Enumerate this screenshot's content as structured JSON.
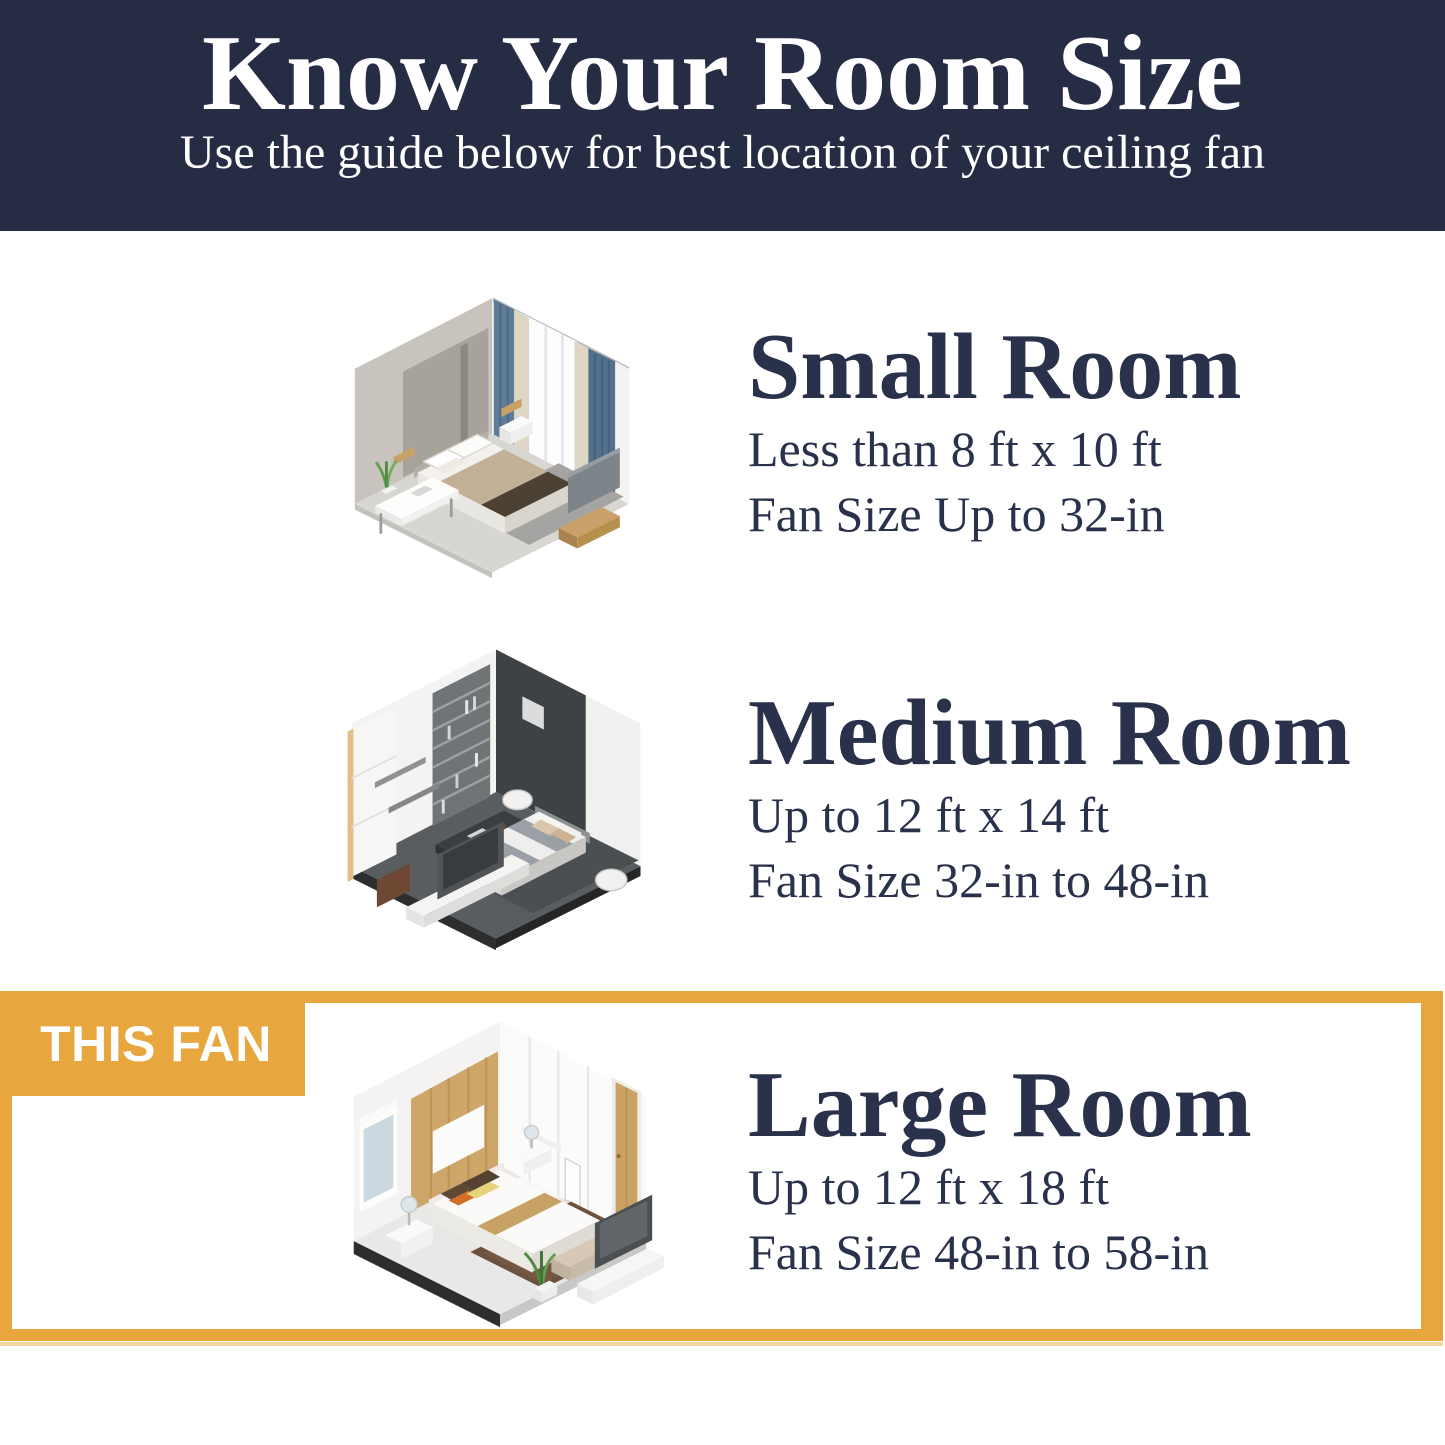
{
  "header": {
    "title": "Know Your Room Size",
    "subtitle": "Use the guide below for best location of your ceiling fan"
  },
  "sections": [
    {
      "name": "Small Room",
      "dimensions": "Less than 8 ft x 10 ft",
      "fan_size": "Fan Size Up to 32-in",
      "illustration": "isometric small bedroom with blue curtains"
    },
    {
      "name": "Medium Room",
      "dimensions": "Up to 12 ft x 14 ft",
      "fan_size": "Fan Size 32-in to 48-in",
      "illustration": "isometric medium bedroom with dark wall and bookshelf"
    },
    {
      "name": "Large Room",
      "dimensions": "Up to 12 ft x 18 ft",
      "fan_size": "Fan Size 48-in to 58-in",
      "illustration": "isometric large bedroom with wood accent wall",
      "highlighted": true
    }
  ],
  "badge": {
    "label": "THIS FAN"
  },
  "colors": {
    "header_bg": "#262C43",
    "text": "#2A314A",
    "highlight_gold": "#E7A63E",
    "badge_text": "#FFFFFF",
    "background": "#FFFFFF"
  }
}
